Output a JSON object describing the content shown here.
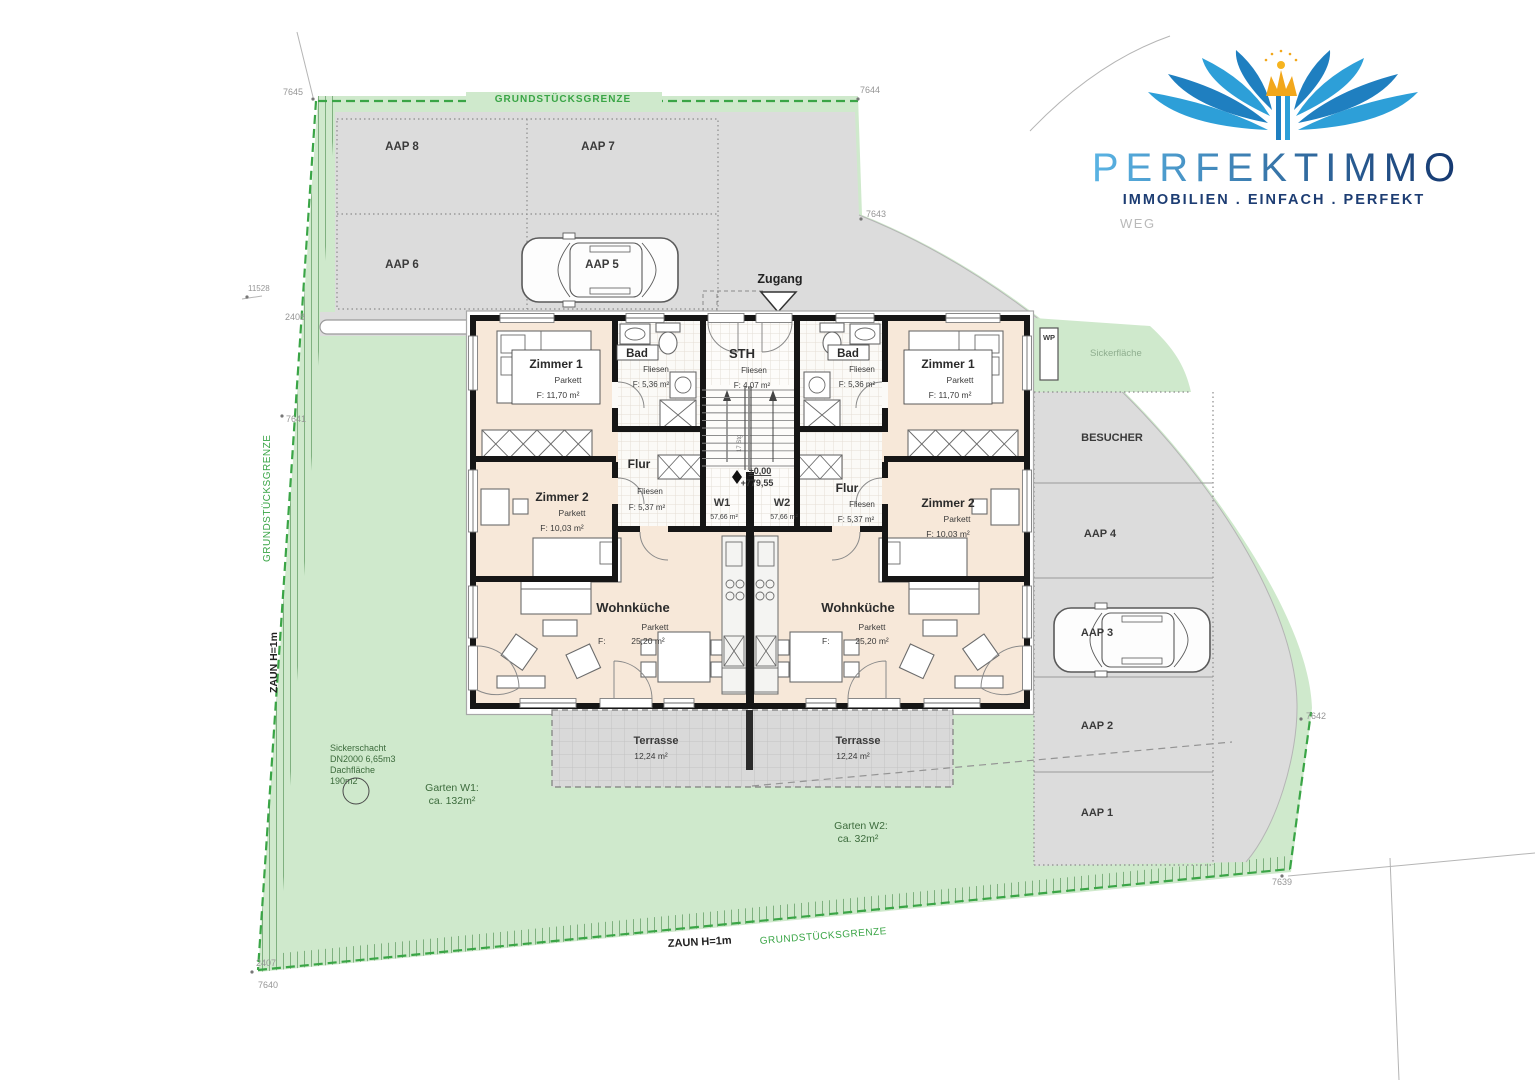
{
  "logo": {
    "title": "PERFEKTIMMO",
    "tagline": "IMMOBILIEN . EINFACH . PERFEKT"
  },
  "boundary": {
    "label": "GRUNDSTÜCKSGRENZE",
    "fence": "ZAUN H=1m"
  },
  "markers": {
    "m7645": "7645",
    "m7644": "7644",
    "m7643": "7643",
    "m7642": "7642",
    "m7641": "7641",
    "m7640": "7640",
    "m7639": "7639",
    "m2408": "2408",
    "m2407": "2407",
    "m11528": "11528"
  },
  "parking": {
    "aap8": "AAP 8",
    "aap7": "AAP 7",
    "aap6": "AAP 6",
    "aap5": "AAP 5",
    "aap4": "AAP 4",
    "aap3": "AAP 3",
    "aap2": "AAP 2",
    "aap1": "AAP 1",
    "besucher": "BESUCHER",
    "wp": "WP"
  },
  "site": {
    "zugang": "Zugang",
    "weg": "WEG",
    "sickerflaeche": "Sickerfläche",
    "sickerschacht": {
      "l1": "Sickerschacht",
      "l2": "DN2000 6,65m3",
      "l3": "Dachfläche",
      "l4": "190m2"
    },
    "garten_w1": "Garten W1:",
    "garten_w1_area": "ca. 132m²",
    "garten_w2": "Garten W2:",
    "garten_w2_area": "ca. 32m²"
  },
  "building": {
    "units": {
      "w1": "W1",
      "w1_area": "57,66 m²",
      "w2": "W2",
      "w2_area": "57,66 m²"
    },
    "level": {
      "rel": "±0,00",
      "abs": "+779,55"
    },
    "stairs": "17 Stg",
    "rooms": {
      "zimmer1": {
        "label": "Zimmer 1",
        "floor": "Parkett",
        "area": "F: 11,70 m²"
      },
      "zimmer2": {
        "label": "Zimmer 2",
        "floor": "Parkett",
        "area": "F: 10,03 m²"
      },
      "bad": {
        "label": "Bad",
        "floor": "Fliesen",
        "area": "F: 5,36 m²"
      },
      "sth": {
        "label": "STH",
        "floor": "Fliesen",
        "area": "F: 4,07 m²"
      },
      "flur": {
        "label": "Flur",
        "floor": "Fliesen",
        "area": "F: 5,37 m²"
      },
      "wohnkueche": {
        "label": "Wohnküche",
        "floor": "Parkett",
        "area": "F:",
        "area_value": "25,20 m²"
      }
    },
    "terrasse": {
      "label": "Terrasse",
      "area": "12,24 m²"
    }
  },
  "colors": {
    "brand_blue": "#2d9fd8",
    "brand_navy": "#1d3d73",
    "crown_orange": "#f2a71b",
    "site_green": "#cfe9cc",
    "boundary_green": "#3aa546",
    "paving_gray": "#dcdcdc",
    "room_peach": "#f7e8d9"
  }
}
